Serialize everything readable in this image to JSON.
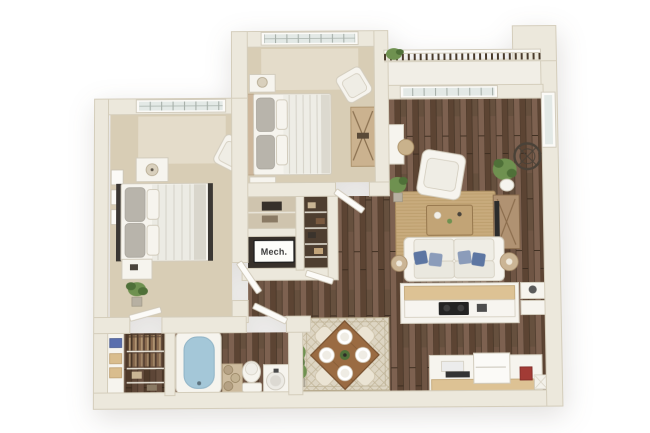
{
  "floorplan": {
    "labels": {
      "mech": "Mech."
    },
    "rooms": [
      {
        "name": "bedroom-1",
        "floor": "carpet",
        "furniture": [
          "bed",
          "nightstands",
          "lamp",
          "armchair",
          "plant",
          "wall-art",
          "window"
        ]
      },
      {
        "name": "bedroom-2",
        "floor": "carpet",
        "furniture": [
          "bed",
          "nightstands",
          "armchair",
          "dresser",
          "window"
        ]
      },
      {
        "name": "living-room",
        "floor": "wood",
        "furniture": [
          "sofa",
          "armchair",
          "coffee-table",
          "area-rug",
          "tv-console",
          "desk",
          "side-lamps",
          "plants",
          "round-mirror",
          "window",
          "sliding-door"
        ]
      },
      {
        "name": "balcony",
        "floor": "deck",
        "furniture": [
          "railing",
          "plant"
        ]
      },
      {
        "name": "kitchen",
        "floor": "wood",
        "furniture": [
          "breakfast-bar",
          "cooktop",
          "refrigerator",
          "counters",
          "baskets",
          "red-appliance"
        ]
      },
      {
        "name": "dining-nook",
        "floor": "wood",
        "furniture": [
          "square-table-rotated",
          "four-chairs",
          "four-place-settings",
          "patterned-rug",
          "plant"
        ]
      },
      {
        "name": "bathroom",
        "floor": "wood",
        "furniture": [
          "bathtub",
          "towel-shelf",
          "toilet",
          "vanity-sink"
        ]
      },
      {
        "name": "walk-in-closet",
        "floor": "wood",
        "furniture": [
          "drawer-unit",
          "hanging-clothes",
          "shelves",
          "blue-bin"
        ]
      },
      {
        "name": "mechanical-closet",
        "label": "Mech."
      },
      {
        "name": "linen-closet"
      },
      {
        "name": "hallway",
        "floor": "wood"
      }
    ],
    "colors": {
      "background": "#ffffff",
      "wall": "#ece8dc",
      "wall_edge": "#d4cdbb",
      "carpet": "#d8cdb5",
      "carpet_light": "#efe9da",
      "wood": "#6f5544",
      "balcony_floor": "#f1eee6",
      "rail_dark": "#4a3b2c",
      "rug_living": "#c8ab7d",
      "rug_living_line": "#a98c5f",
      "rug_dining": "#ddd5c3",
      "rug_dining_line": "#b6a98c",
      "white_furniture": "#f6f4ee",
      "furn_stroke": "#d2ccbd",
      "gray_pillow": "#b8b4ab",
      "blue_pillow": "#5d76a2",
      "blue_pillow_lt": "#8b9cba",
      "tub_water": "#a4c7d8",
      "counter_wood": "#ddc294",
      "table_wood": "#9a6b42",
      "table_wood_dark": "#77502e",
      "plant": "#6f9150",
      "plant_dark": "#4f7038",
      "dark": "#2e2b27",
      "glass": "#e3e9e6",
      "mirror": "#4a4238",
      "label_bg": "#fdfdfa",
      "label_text": "#3a3a3a",
      "red_appliance": "#a23b35"
    }
  }
}
